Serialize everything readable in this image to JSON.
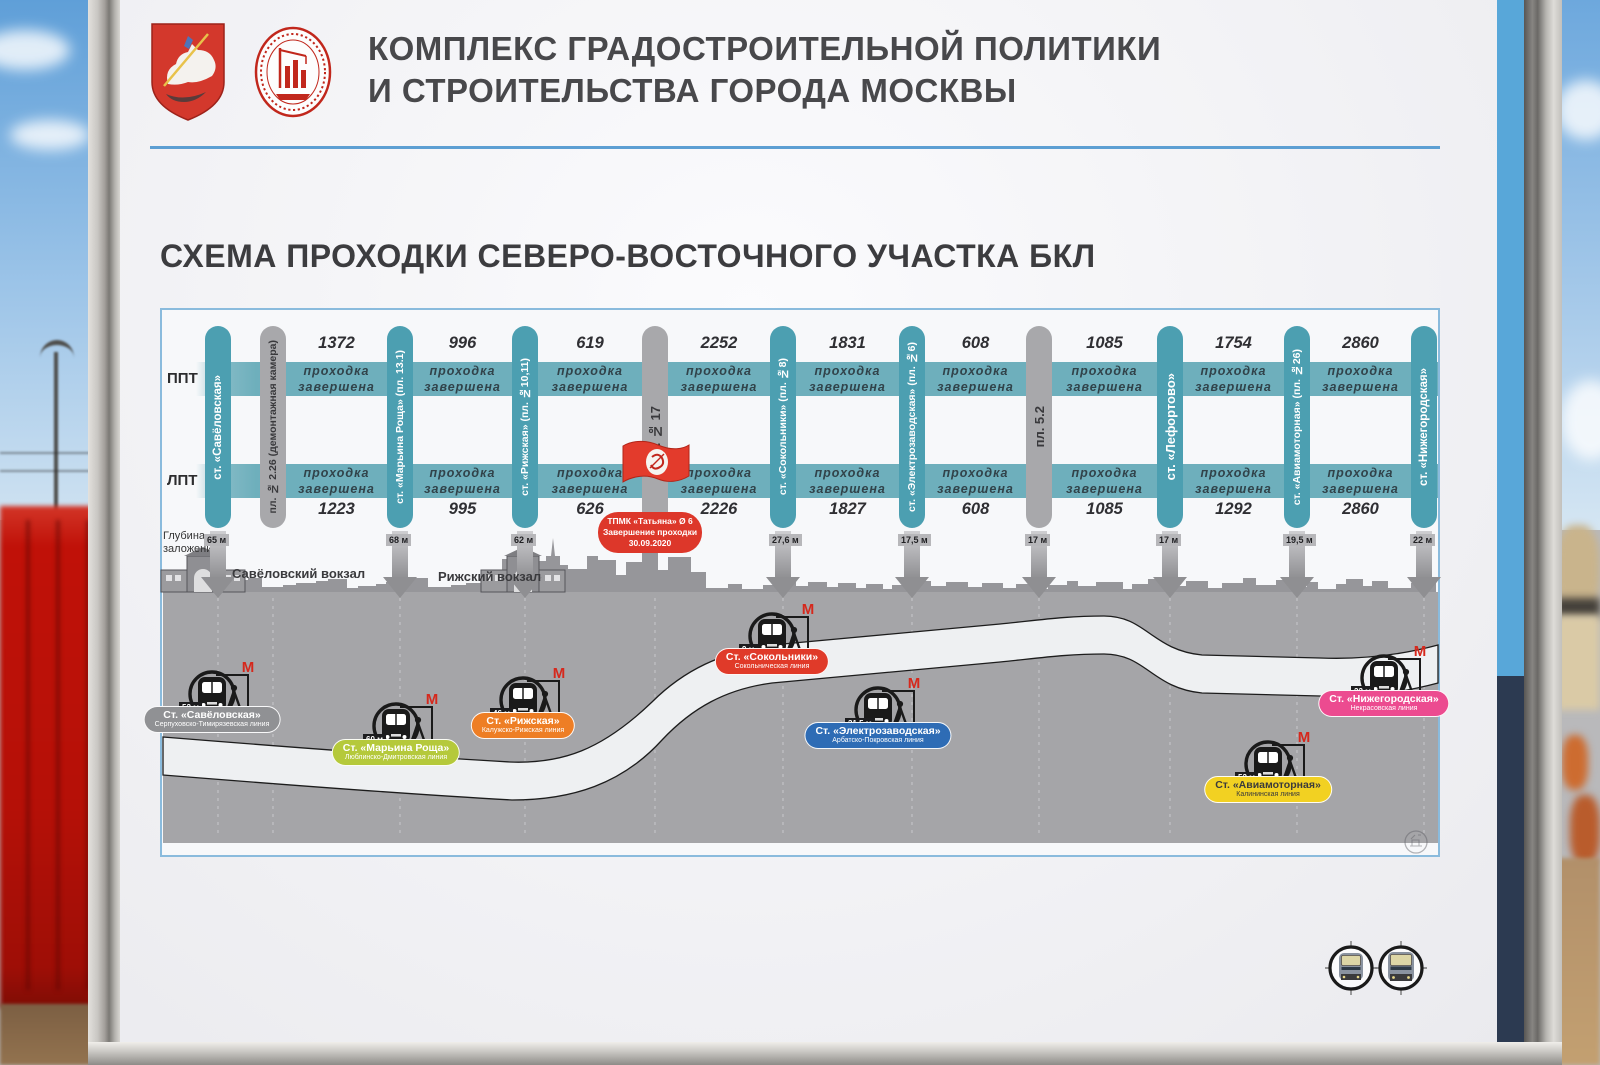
{
  "header": {
    "org_line1": "КОМПЛЕКС ГРАДОСТРОИТЕЛЬНОЙ ПОЛИТИКИ",
    "org_line2": "И СТРОИТЕЛЬСТВА ГОРОДА МОСКВЫ",
    "logo_ring_text": "СТРОИТЕЛЬНЫЙ КОМПЛЕКС МОСКВЫ"
  },
  "title": "СХЕМА ПРОХОДКИ СЕВЕРО-ВОСТОЧНОГО УЧАСТКА БКЛ",
  "colors": {
    "accent_blue": "#5d9fd3",
    "teal_band": "#6eafbc",
    "teal_pill": "#4c9fb1",
    "gray_pill": "#a8a8ab",
    "red": "#dd372a",
    "ground_gray": "#a5a5a8",
    "stripe_light_blue": "#58a7d9",
    "stripe_navy": "#2c3a51"
  },
  "diagram": {
    "track_labels": {
      "top": "ППТ",
      "bottom": "ЛПТ"
    },
    "depth_caption": "Глубина\nзаложения",
    "stations": [
      {
        "label": "ст. «Савёловская»",
        "kind": "station",
        "x": 218,
        "depth": "65 м"
      },
      {
        "label": "пл. № 2.26 (демонтажная камера)",
        "kind": "shaft",
        "x": 273,
        "depth": null
      },
      {
        "label": "ст. «Марьина Роща» (пл. 13.1)",
        "kind": "station",
        "x": 400,
        "depth": "68 м"
      },
      {
        "label": "ст. «Рижская» (пл. №10,11)",
        "kind": "station",
        "x": 525,
        "depth": "62 м"
      },
      {
        "label": "пл. № 17",
        "kind": "shaft",
        "x": 655,
        "depth": null
      },
      {
        "label": "ст. «Сокольники» (пл. №8)",
        "kind": "station",
        "x": 783,
        "depth": "27,6 м"
      },
      {
        "label": "ст. «Электрозаводская» (пл. №6)",
        "kind": "station",
        "x": 912,
        "depth": "17,5 м"
      },
      {
        "label": "пл. 5.2",
        "kind": "shaft",
        "x": 1039,
        "depth": "17 м"
      },
      {
        "label": "ст. «Лефортово»",
        "kind": "station",
        "x": 1170,
        "depth": "17 м"
      },
      {
        "label": "ст. «Авиамоторная» (пл. №26)",
        "kind": "station",
        "x": 1297,
        "depth": "19,5 м"
      },
      {
        "label": "ст. «Нижегородская»",
        "kind": "station",
        "x": 1424,
        "depth": "22 м"
      }
    ],
    "segments": [
      {
        "top": "1372",
        "bottom": "1223",
        "status": "проходка\nзавершена"
      },
      {
        "top": "996",
        "bottom": "995",
        "status": "проходка\nзавершена"
      },
      {
        "top": "619",
        "bottom": "626",
        "status": "проходка\nзавершена"
      },
      {
        "top": "2252",
        "bottom": "2226",
        "status": "проходка\nзавершена"
      },
      {
        "top": "1831",
        "bottom": "1827",
        "status": "проходка\nзавершена"
      },
      {
        "top": "608",
        "bottom": "608",
        "status": "проходка\nзавершена"
      },
      {
        "top": "1085",
        "bottom": "1085",
        "status": "проходка\nзавершена"
      },
      {
        "top": "1754",
        "bottom": "1292",
        "status": "проходка\nзавершена"
      },
      {
        "top": "2860",
        "bottom": "2860",
        "status": "проходка\nзавершена"
      }
    ],
    "tbm_note": {
      "line1": "ТПМК «Татьяна» Ø 6",
      "line2": "Завершение проходки",
      "line3": "30.09.2020"
    },
    "terminals": [
      {
        "name": "Савёловский вокзал",
        "label_x": 232,
        "label_y": 566,
        "building_x": 203
      },
      {
        "name": "Рижский вокзал",
        "label_x": 438,
        "label_y": 569,
        "building_x": 523
      }
    ],
    "metro_stations": [
      {
        "name": "Ст. «Савёловская»",
        "line": "Серпуховско-Тимирязевская линия",
        "depth": "52 м",
        "color": "#909194",
        "text_color": "#ffffff",
        "x": 212,
        "icon_y": 660,
        "label_y": 706
      },
      {
        "name": "Ст. «Марьина Роща»",
        "line": "Люблинско-Дмитровская линия",
        "depth": "60 м",
        "color": "#b5c93b",
        "text_color": "#ffffff",
        "x": 396,
        "icon_y": 692,
        "label_y": 739
      },
      {
        "name": "Ст. «Рижская»",
        "line": "Калужско-Рижская линия",
        "depth": "46 м",
        "color": "#ee7e25",
        "text_color": "#ffffff",
        "x": 523,
        "icon_y": 666,
        "label_y": 712
      },
      {
        "name": "Ст. «Сокольники»",
        "line": "Сокольническая линия",
        "depth": "9 м",
        "color": "#e03a29",
        "text_color": "#ffffff",
        "x": 772,
        "icon_y": 602,
        "label_y": 648
      },
      {
        "name": "Ст. «Электрозаводская»",
        "line": "Арбатско-Покровская линия",
        "depth": "31,5 м",
        "color": "#2e6cb5",
        "text_color": "#ffffff",
        "x": 878,
        "icon_y": 676,
        "label_y": 722
      },
      {
        "name": "Ст. «Авиамоторная»",
        "line": "Калининская линия",
        "depth": "52 м",
        "color": "#f2d122",
        "text_color": "#3a3a3c",
        "x": 1268,
        "icon_y": 730,
        "label_y": 776
      },
      {
        "name": "Ст. «Нижегородская»",
        "line": "Некрасовская линия",
        "depth": "22 м",
        "color": "#ec4b90",
        "text_color": "#ffffff",
        "x": 1384,
        "icon_y": 644,
        "label_y": 690
      }
    ]
  }
}
